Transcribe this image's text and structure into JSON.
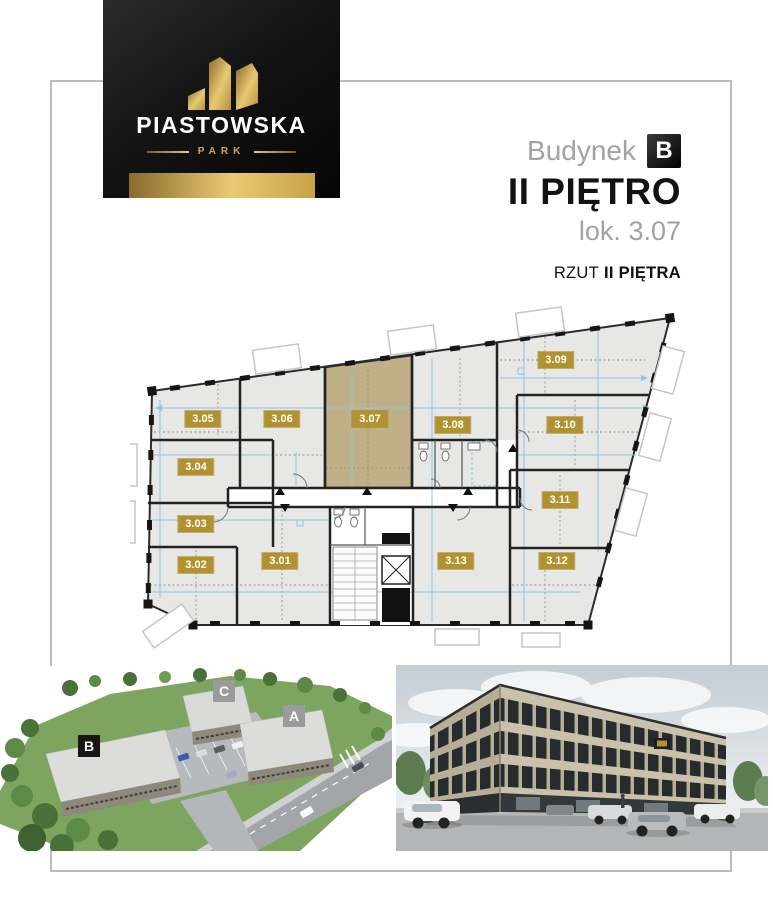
{
  "logo": {
    "title": "PIASTOWSKA",
    "subtitle": "PARK"
  },
  "header": {
    "building_label": "Budynek",
    "building_badge": "B",
    "floor_title": "II PIĘTRO",
    "unit_label": "lok. 3.07",
    "caption_prefix": "RZUT",
    "caption_bold": "II PIĘTRA"
  },
  "plan": {
    "highlighted_unit": "3.07",
    "units": [
      {
        "code": "3.01"
      },
      {
        "code": "3.02"
      },
      {
        "code": "3.03"
      },
      {
        "code": "3.04"
      },
      {
        "code": "3.05"
      },
      {
        "code": "3.06"
      },
      {
        "code": "3.07",
        "highlighted": true
      },
      {
        "code": "3.08"
      },
      {
        "code": "3.09"
      },
      {
        "code": "3.10"
      },
      {
        "code": "3.11"
      },
      {
        "code": "3.12"
      },
      {
        "code": "3.13"
      }
    ]
  },
  "site": {
    "labels": [
      "B",
      "C",
      "A"
    ]
  },
  "colors": {
    "badge_gold": "#b2912f",
    "unit_highlight": "#c0b088",
    "dimension_blue": "#8fc3e4",
    "logo_gold": "#d9b45c",
    "frame_gray": "#bcbcbc",
    "wall_dark": "#222222"
  }
}
